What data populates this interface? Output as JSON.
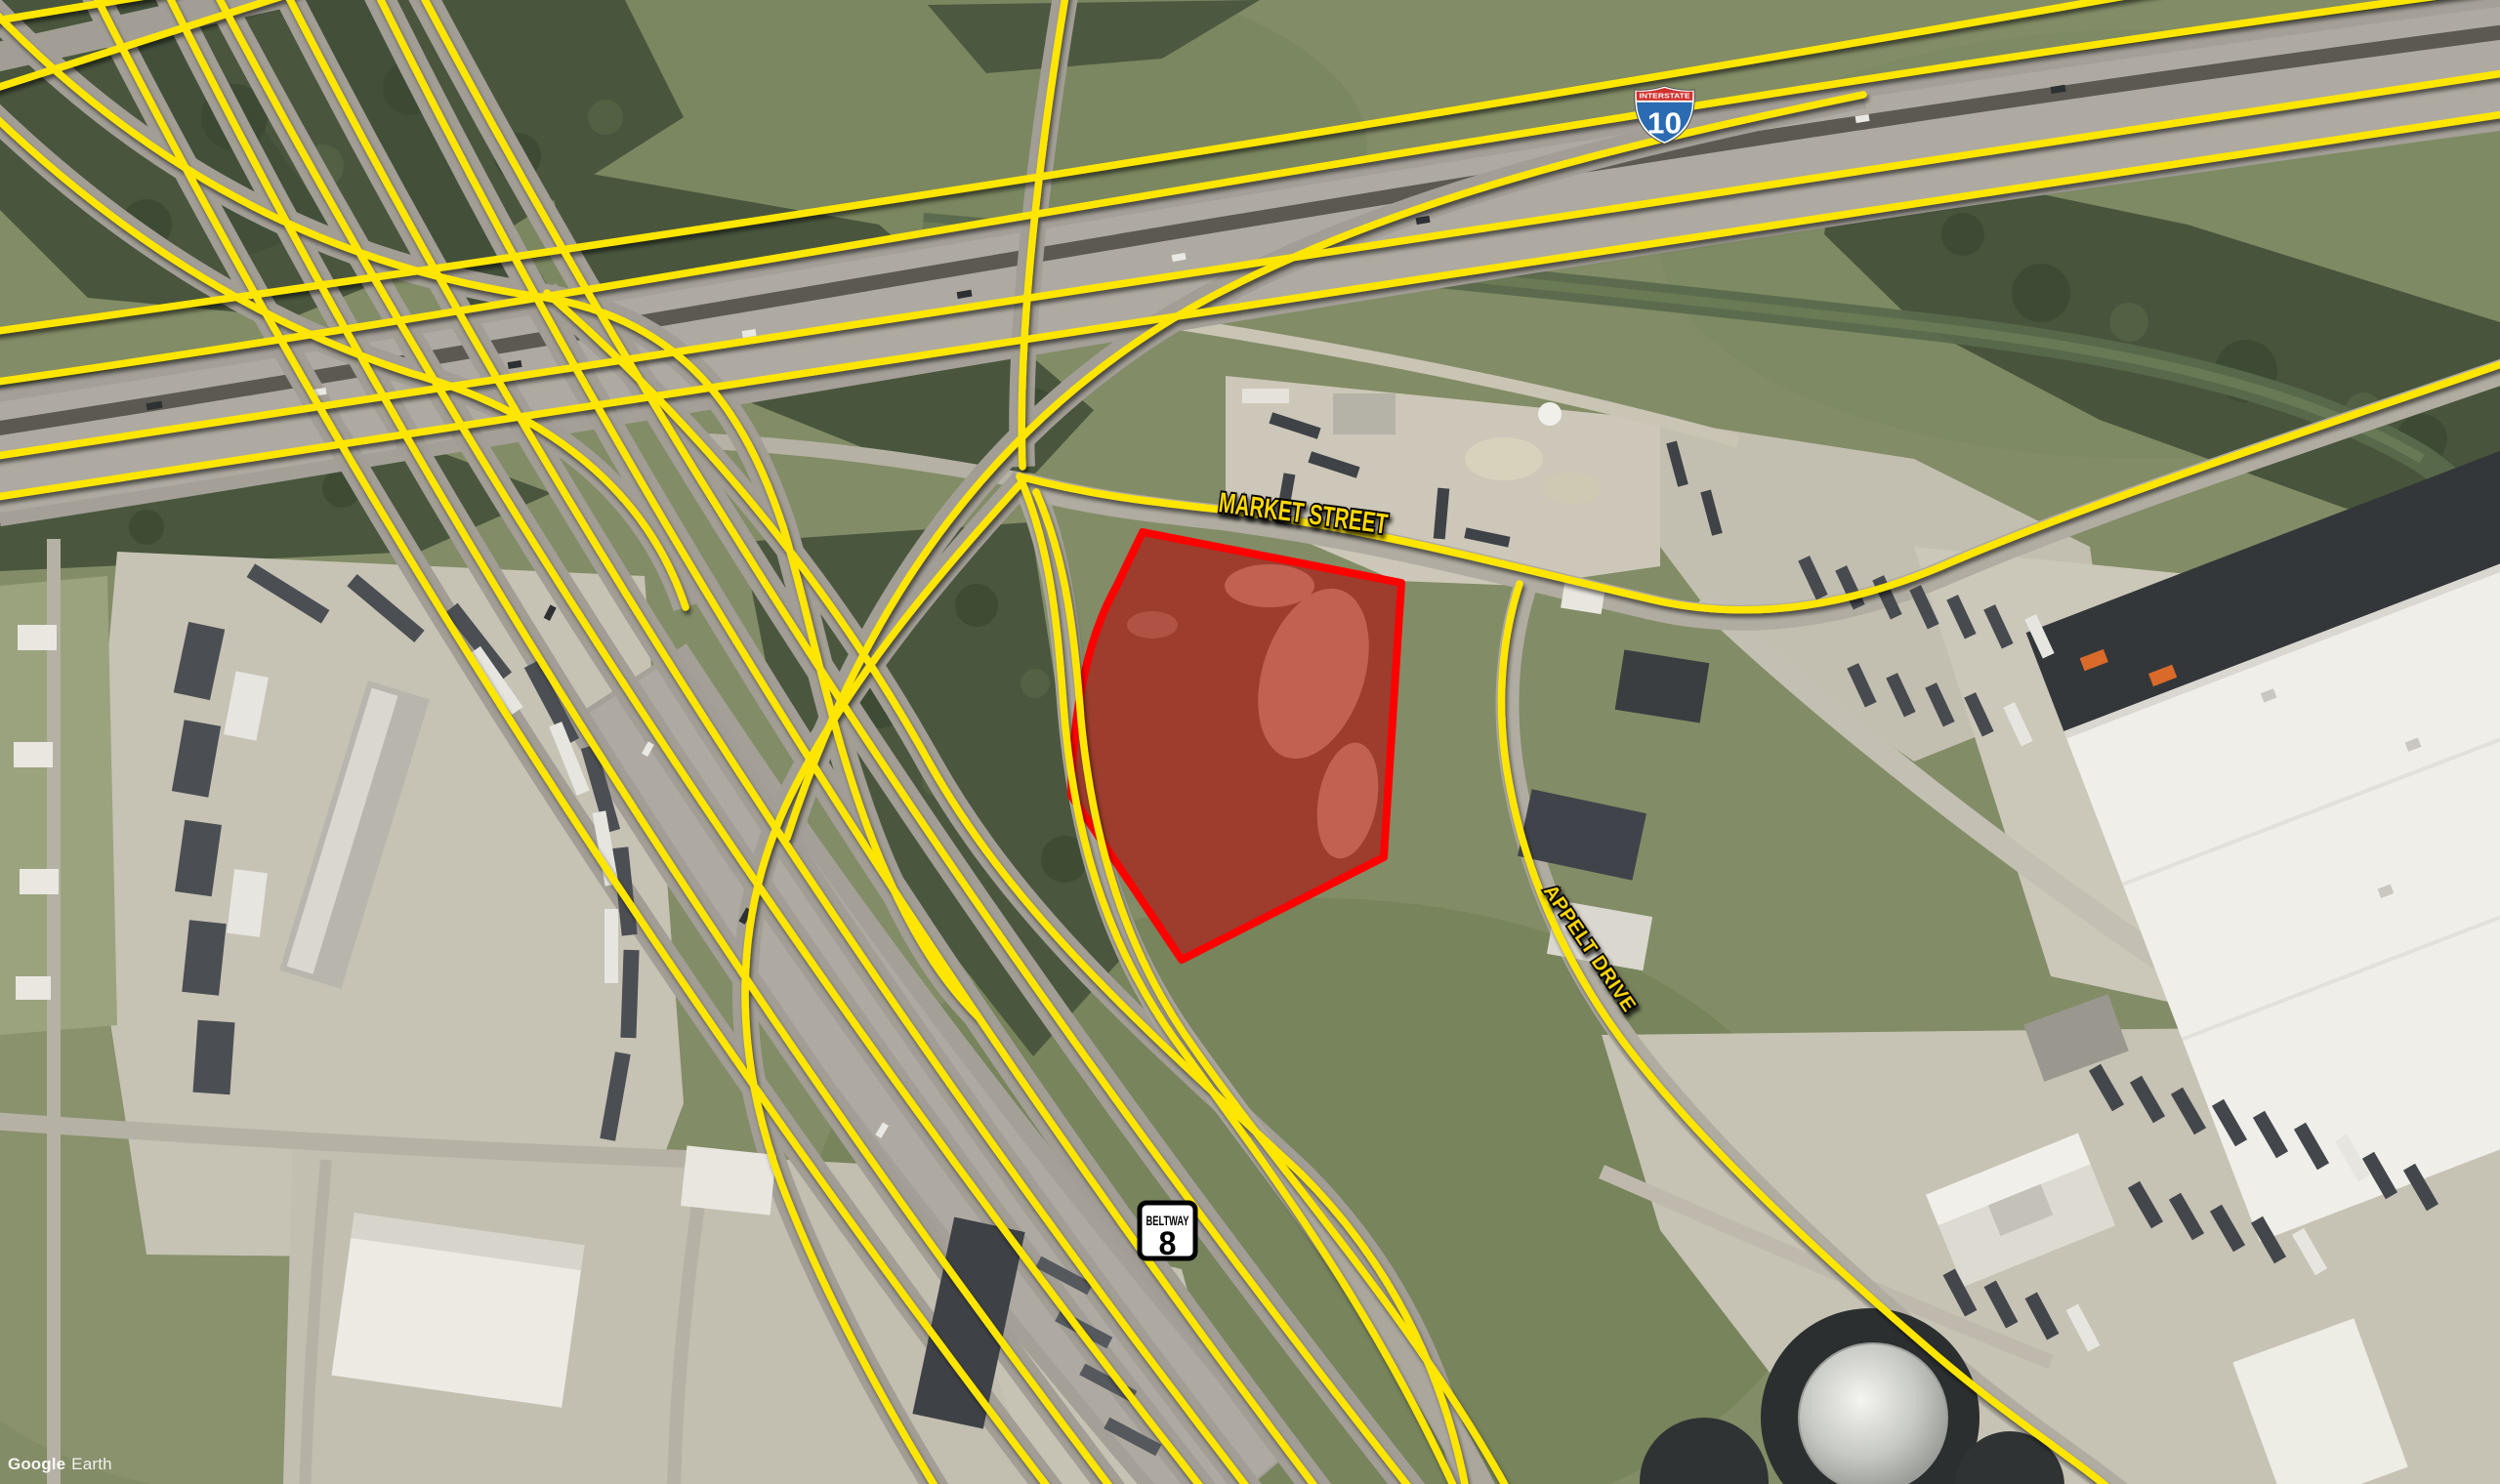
{
  "map": {
    "attribution": {
      "brand": "Google",
      "product": "Earth"
    },
    "road_labels": {
      "market_street": "MARKET STREET",
      "appelt_drive": "APPELT DRIVE"
    },
    "shields": {
      "interstate_10": {
        "banner": "INTERSTATE",
        "number": "10"
      },
      "beltway_8": {
        "name": "BELTWAY",
        "number": "8"
      }
    },
    "overlay_colors": {
      "route_line": "#ffe600",
      "parcel_outline": "#ff0000",
      "parcel_fill_tint": "rgba(216,36,24,0.34)",
      "road_label_text": "#ffd800"
    }
  }
}
